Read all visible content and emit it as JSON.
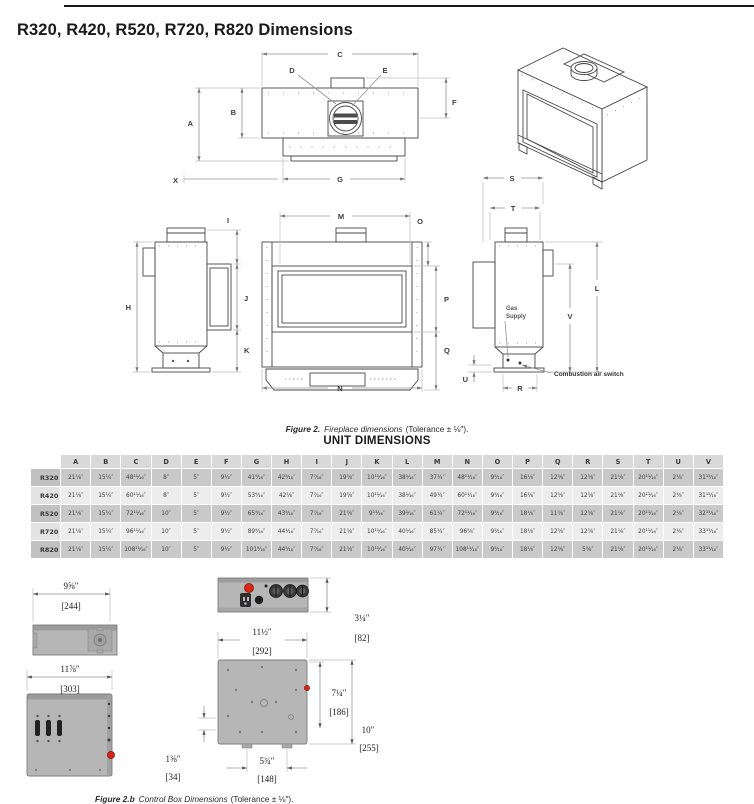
{
  "page": {
    "title": "R320, R420, R520, R720, R820 Dimensions"
  },
  "figure2": {
    "caption": {
      "label": "Figure 2.",
      "text": "Fireplace dimensions",
      "tolerance": "(Tolerance ± ⅛″)."
    },
    "labels": {
      "A": "A",
      "B": "B",
      "C": "C",
      "D": "D",
      "E": "E",
      "F": "F",
      "G": "G",
      "H": "H",
      "I": "I",
      "J": "J",
      "K": "K",
      "L": "L",
      "M": "M",
      "N": "N",
      "O": "O",
      "P": "P",
      "Q": "Q",
      "R": "R",
      "S": "S",
      "T": "T",
      "U": "U",
      "V": "V",
      "X": "X"
    },
    "annotations": {
      "gas_line1": "Gas",
      "gas_line2": "Supply",
      "combustion": "Combustion air switch"
    }
  },
  "unit_dimensions": {
    "title": "UNIT DIMENSIONS",
    "columns": [
      "A",
      "B",
      "C",
      "D",
      "E",
      "F",
      "G",
      "H",
      "I",
      "J",
      "K",
      "L",
      "M",
      "N",
      "O",
      "P",
      "Q",
      "R",
      "S",
      "T",
      "U",
      "V"
    ],
    "rows": [
      {
        "model": "R320",
        "values": [
          "21⅛″",
          "15¼″",
          "48¹¹⁄₁₆″",
          "8″",
          "5″",
          "9½″",
          "41⁹⁄₁₆″",
          "42⁵⁄₁₆″",
          "7⁷⁄₁₆″",
          "19⅝″",
          "10¹¹⁄₁₆″",
          "38¹⁄₁₆″",
          "37¼″",
          "48¹¹⁄₁₆″",
          "9⁵⁄₁₆″",
          "16⅛″",
          "12⅝″",
          "12⅝″",
          "21⅛″",
          "20¹¹⁄₁₆″",
          "2⅛″",
          "31¹⁵⁄₁₆″"
        ]
      },
      {
        "model": "R420",
        "values": [
          "21⅛″",
          "15¼″",
          "60¹¹⁄₁₆″",
          "8″",
          "5″",
          "9½″",
          "53⁹⁄₁₆″",
          "42⅛″",
          "7⁷⁄₁₆″",
          "19⅝″",
          "10¹¹⁄₁₆″",
          "38¹⁄₁₆″",
          "49¼″",
          "60¹¹⁄₁₆″",
          "9⁵⁄₁₆″",
          "16⅛″",
          "12⅝″",
          "12⅝″",
          "21⅛″",
          "20¹¹⁄₁₆″",
          "2⅛″",
          "31¹⁵⁄₁₆″"
        ]
      },
      {
        "model": "R520",
        "values": [
          "21⅛″",
          "15¼″",
          "72¹¹⁄₁₆″",
          "10″",
          "5″",
          "9½″",
          "65⁹⁄₁₆″",
          "43⁵⁄₁₆″",
          "7⁷⁄₁₆″",
          "21⅝″",
          "9¹³⁄₁₆″",
          "39¹⁄₁₆″",
          "61¼″",
          "72¹¹⁄₁₆″",
          "9⁵⁄₁₆″",
          "18⅛″",
          "11⅝″",
          "12⅝″",
          "21⅛″",
          "20¹¹⁄₁₆″",
          "2⅛″",
          "32¹⁵⁄₁₆″"
        ]
      },
      {
        "model": "R720",
        "values": [
          "21⅛″",
          "15¼″",
          "96¹¹⁄₁₆″",
          "10″",
          "5″",
          "9½″",
          "89⁹⁄₁₆″",
          "44¹⁄₁₆″",
          "7⁷⁄₁₆″",
          "21⅝″",
          "10¹¹⁄₁₆″",
          "40¹⁄₁₆″",
          "85¼″",
          "96⅝″",
          "9⁵⁄₁₆″",
          "18⅛″",
          "12⅝″",
          "12⅝″",
          "21⅛″",
          "20¹¹⁄₁₆″",
          "2⅛″",
          "33¹⁵⁄₁₆″"
        ]
      },
      {
        "model": "R820",
        "values": [
          "21⅛″",
          "15¼″",
          "108¹¹⁄₁₆″",
          "10″",
          "5″",
          "9½″",
          "101⁹⁄₁₆″",
          "44⁵⁄₁₆″",
          "7⁷⁄₁₆″",
          "21⅝″",
          "10¹¹⁄₁₆″",
          "40¹⁄₁₆″",
          "97¼″",
          "108¹¹⁄₁₆″",
          "9⁵⁄₁₆″",
          "18⅛″",
          "12⅝″",
          "5⅝″",
          "21⅛″",
          "20¹¹⁄₁₆″",
          "2⅛″",
          "33¹⁵⁄₁₆″"
        ]
      }
    ]
  },
  "figure2b": {
    "caption": {
      "label": "Figure 2.b",
      "text": "Control Box Dimensions",
      "tolerance": "(Tolerance ± ⅛″)."
    },
    "dims": {
      "top_width_in": "9⅝″",
      "top_width_mm": "[244]",
      "front_height_in": "3¼″",
      "front_height_mm": "[82]",
      "bottom_width_in": "11½″",
      "bottom_width_mm": "[292]",
      "bottom_depth_in": "7¼″",
      "bottom_depth_mm": "[186]",
      "side_height_in": "10″",
      "side_height_mm": "[255]",
      "bottom_offset_in": "1⅜″",
      "bottom_offset_mm": "[34]",
      "bottom_center_in": "5¾″",
      "bottom_center_mm": "[148]",
      "side_width_in": "11⅞″",
      "side_width_mm": "[303]"
    }
  }
}
